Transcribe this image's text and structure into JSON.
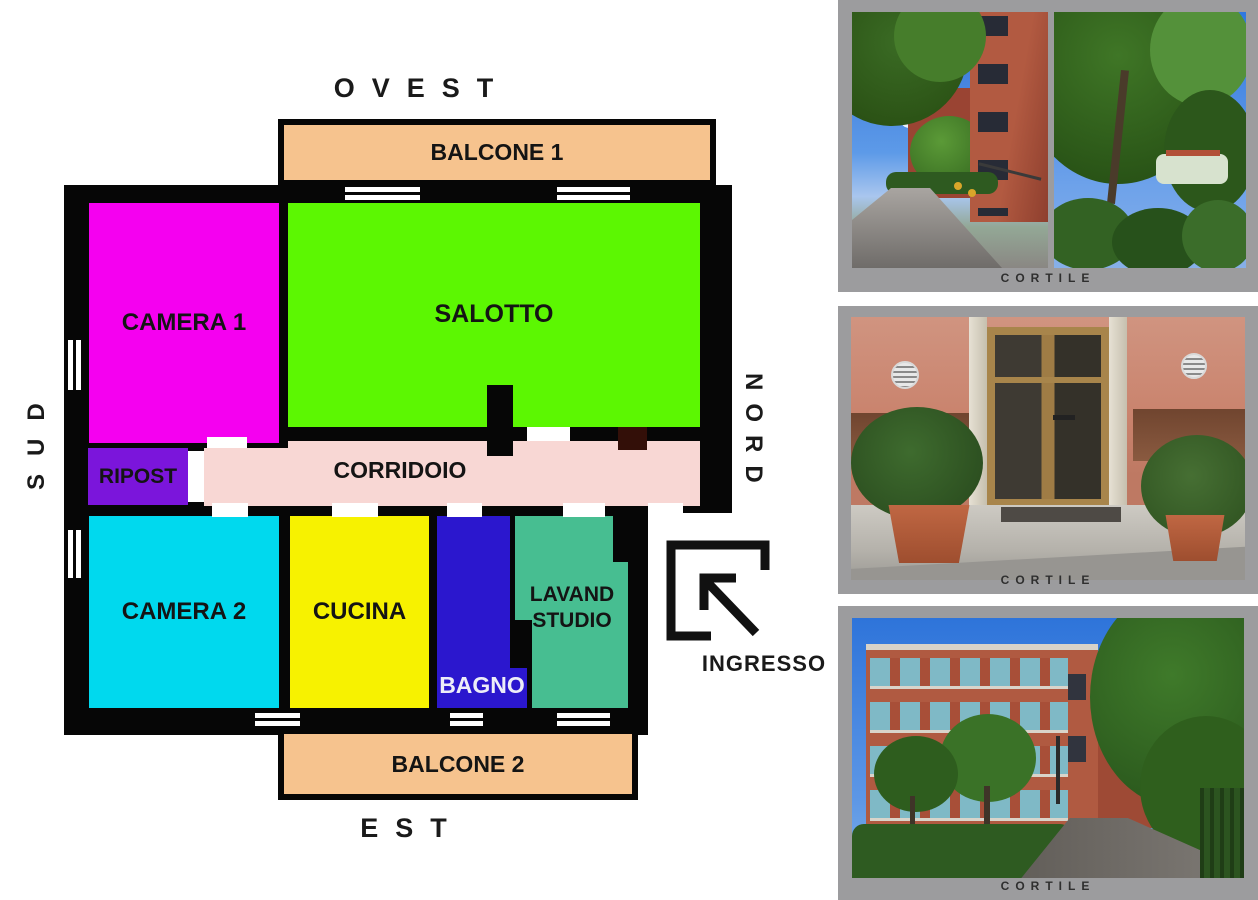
{
  "plan": {
    "compass": {
      "west": "OVEST",
      "east": "EST",
      "south": "SUD",
      "north": "NORD"
    },
    "balcony1": {
      "label": "BALCONE 1",
      "color": "#F6C38E"
    },
    "balcony2": {
      "label": "BALCONE 2",
      "color": "#F6C38E"
    },
    "rooms": {
      "camera1": {
        "label": "CAMERA 1",
        "color": "#F500F0"
      },
      "salotto": {
        "label": "SALOTTO",
        "color": "#5CF702"
      },
      "ripost": {
        "label": "RIPOST",
        "color": "#7B15DB"
      },
      "corridoio": {
        "label": "CORRIDOIO",
        "color": "#F8D7D4"
      },
      "camera2": {
        "label": "CAMERA 2",
        "color": "#00D9EE"
      },
      "cucina": {
        "label": "CUCINA",
        "color": "#F7F200"
      },
      "bagno": {
        "label": "BAGNO",
        "color": "#2B17CE",
        "label_color": "#EDEDF8"
      },
      "lavand": {
        "label_line1": "LAVAND",
        "label_line2": "STUDIO",
        "color": "#47BE91"
      }
    },
    "entrance": {
      "label": "INGRESSO"
    },
    "colors": {
      "walls": "#060606",
      "door_leaf": "#330F08"
    }
  },
  "photos": {
    "card_bg": "#9C9C9E",
    "items": [
      {
        "caption": "CORTILE"
      },
      {
        "caption": "CORTILE"
      },
      {
        "caption": "CORTILE"
      }
    ]
  }
}
